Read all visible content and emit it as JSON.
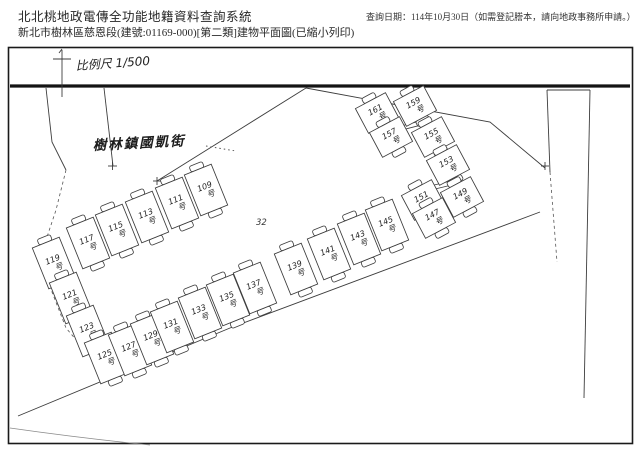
{
  "header": {
    "system_title": "北北桃地政電傳全功能地籍資料查詢系統",
    "query_date": "查詢日期：114年10月30日（如需登記謄本，請向地政事務所申請。）",
    "doc_title": "新北市樹林區慈恩段(建號:01169-000)[第二類]建物平面圖(已縮小列印)"
  },
  "plan": {
    "scale_label": "比例尺 1/500",
    "street_label": "樹林鎮國凱街",
    "lot_number": "32",
    "unit_suffix": "号",
    "units": [
      {
        "no": "109",
        "x": 206,
        "y": 190
      },
      {
        "no": "111",
        "x": 177,
        "y": 203
      },
      {
        "no": "113",
        "x": 147,
        "y": 217
      },
      {
        "no": "115",
        "x": 117,
        "y": 230
      },
      {
        "no": "117",
        "x": 88,
        "y": 243
      },
      {
        "no": "119",
        "x": 54,
        "y": 263
      },
      {
        "no": "121",
        "x": 71,
        "y": 298
      },
      {
        "no": "123",
        "x": 88,
        "y": 331
      },
      {
        "no": "125",
        "x": 106,
        "y": 358
      },
      {
        "no": "127",
        "x": 130,
        "y": 350
      },
      {
        "no": "129",
        "x": 152,
        "y": 339
      },
      {
        "no": "131",
        "x": 172,
        "y": 327
      },
      {
        "no": "133",
        "x": 200,
        "y": 313
      },
      {
        "no": "135",
        "x": 228,
        "y": 300
      },
      {
        "no": "137",
        "x": 255,
        "y": 288
      },
      {
        "no": "139",
        "x": 296,
        "y": 269
      },
      {
        "no": "141",
        "x": 329,
        "y": 254
      },
      {
        "no": "143",
        "x": 359,
        "y": 239
      },
      {
        "no": "145",
        "x": 387,
        "y": 225
      },
      {
        "no": "161",
        "x": 377,
        "y": 113,
        "r": -28,
        "w": 34,
        "h": 28
      },
      {
        "no": "159",
        "x": 415,
        "y": 106,
        "r": -28,
        "w": 34,
        "h": 28
      },
      {
        "no": "157",
        "x": 391,
        "y": 137,
        "r": -28,
        "w": 34,
        "h": 28
      },
      {
        "no": "155",
        "x": 433,
        "y": 137,
        "r": -28,
        "w": 34,
        "h": 28
      },
      {
        "no": "153",
        "x": 448,
        "y": 165,
        "r": -28,
        "w": 34,
        "h": 28
      },
      {
        "no": "151",
        "x": 423,
        "y": 200,
        "r": -28,
        "w": 34,
        "h": 28
      },
      {
        "no": "149",
        "x": 462,
        "y": 197,
        "r": -28,
        "w": 34,
        "h": 28
      },
      {
        "no": "147",
        "x": 434,
        "y": 218,
        "r": -28,
        "w": 34,
        "h": 28
      }
    ]
  }
}
